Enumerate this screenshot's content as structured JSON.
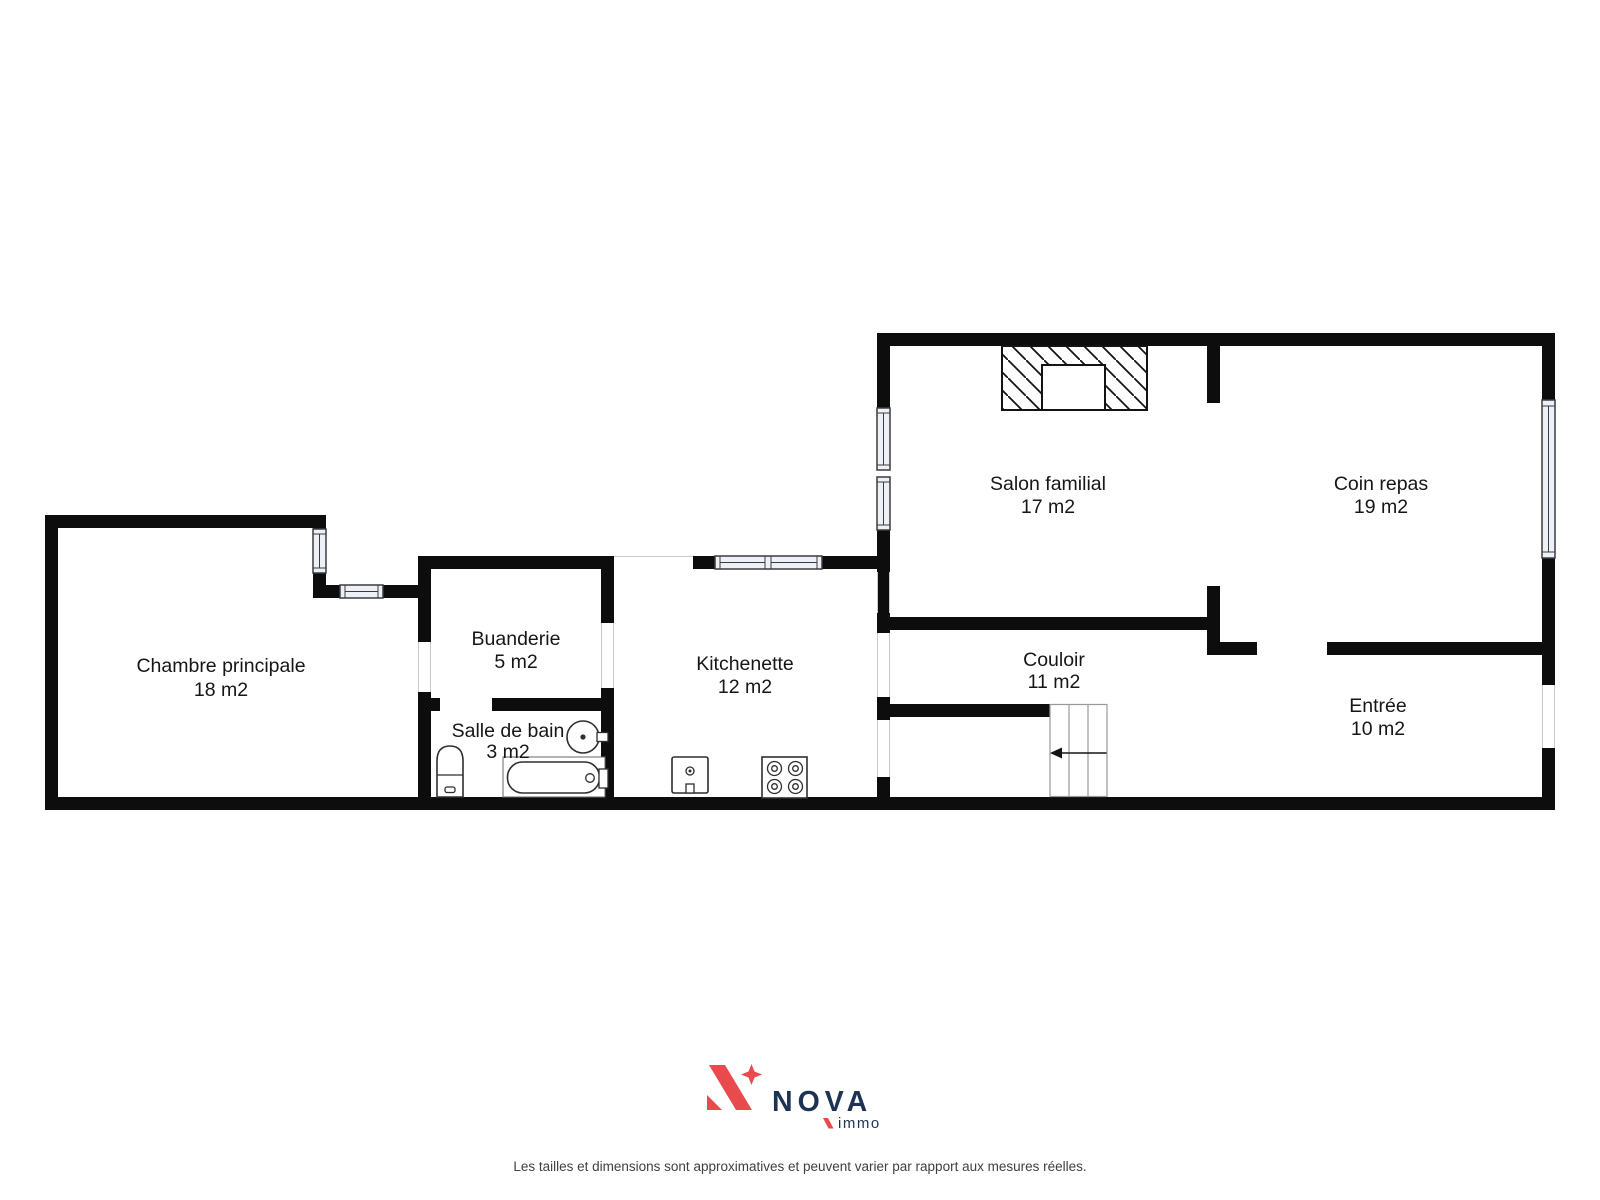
{
  "colors": {
    "wall": "#0d0d0d",
    "window_fill": "#eef0f7",
    "brand_red": "#e94a4e",
    "brand_navy": "#1d3354"
  },
  "rooms": [
    {
      "id": "chambre-principale",
      "name": "Chambre principale",
      "area": "18 m2"
    },
    {
      "id": "buanderie",
      "name": "Buanderie",
      "area": "5 m2"
    },
    {
      "id": "salle-de-bain",
      "name": "Salle de bain",
      "area": "3 m2"
    },
    {
      "id": "kitchenette",
      "name": "Kitchenette",
      "area": "12 m2"
    },
    {
      "id": "salon-familial",
      "name": "Salon familial",
      "area": "17 m2"
    },
    {
      "id": "coin-repas",
      "name": "Coin repas",
      "area": "19 m2"
    },
    {
      "id": "couloir",
      "name": "Couloir",
      "area": "11 m2"
    },
    {
      "id": "entree",
      "name": "Entrée",
      "area": "10 m2"
    }
  ],
  "footer": {
    "brand": "NOVA",
    "brand_sub": "immo",
    "disclaimer": "Les tailles et dimensions sont approximatives et peuvent varier par rapport aux mesures réelles."
  }
}
